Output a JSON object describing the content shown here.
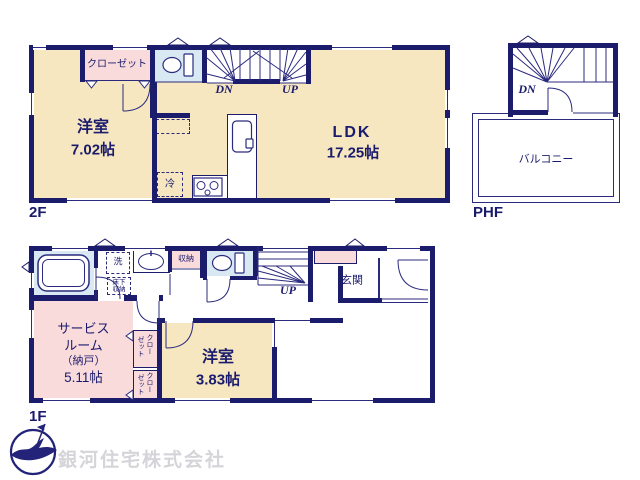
{
  "colors": {
    "wall": "#1c1c6c",
    "thin": "#2b2b7e",
    "tan": "#f6e7c0",
    "pink": "#fadbdb",
    "blue": "#d9e9f4",
    "ink": "#1b1b6d",
    "gray": "#d5d5d9"
  },
  "company": "銀河住宅株式会社",
  "floor2": {
    "name": "2F",
    "room1": "洋室",
    "room1_size": "7.02帖",
    "ldk": "LDK",
    "ldk_size": "17.25帖",
    "closet": "クローゼット",
    "fridge": "冷",
    "dn": "DN",
    "up": "UP"
  },
  "phf": {
    "name": "PHF",
    "balcony": "バルコニー",
    "dn": "DN"
  },
  "floor1": {
    "name": "1F",
    "service1": "サービス",
    "service2": "ルーム",
    "service3": "（納戸）",
    "service4": "5.11帖",
    "room": "洋室",
    "room_size": "3.83帖",
    "entrance": "玄関",
    "storage": "収納",
    "washer": "洗",
    "underfloor1": "床下",
    "underfloor2": "収納",
    "closet_a": "クロー",
    "closet_b": "ゼット",
    "up": "UP"
  }
}
